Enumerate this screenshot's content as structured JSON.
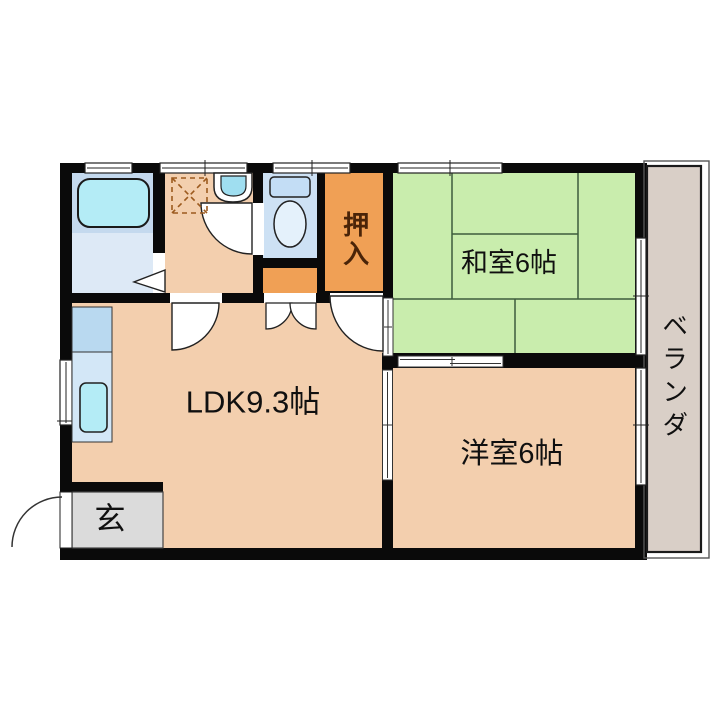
{
  "plan": {
    "type": "apartment-floor-plan",
    "rooms": {
      "washitsu": {
        "label": "和室6帖"
      },
      "oshiire": {
        "label": "押入"
      },
      "ldk": {
        "label": "LDK9.3帖"
      },
      "youshitsu": {
        "label": "洋室6帖"
      },
      "veranda": {
        "label": "ベランダ"
      },
      "genkan": {
        "label": "玄"
      }
    },
    "fixtures": [
      {
        "name": "bathtub-icon"
      },
      {
        "name": "washing-machine-space-icon"
      },
      {
        "name": "washbasin-icon"
      },
      {
        "name": "toilet-icon"
      },
      {
        "name": "kitchen-sink-icon"
      },
      {
        "name": "swing-door-icon"
      },
      {
        "name": "double-swing-door-icon"
      },
      {
        "name": "folding-door-icon"
      },
      {
        "name": "sliding-door-icon"
      },
      {
        "name": "window-icon"
      },
      {
        "name": "entrance-door-arc-icon"
      }
    ],
    "colors": {
      "wall": "#0a0a0a",
      "tatami_green": "#c9edad",
      "tatami_line": "#3d5c3d",
      "floor_tan": "#f3cfae",
      "closet_orange": "#f0a055",
      "bath_upper_blue": "#c4d9ee",
      "bath_lower_blue": "#dde9f6",
      "fixture_cyan": "#b4ecf6",
      "toilet_floor_blue": "#cde1f4",
      "toilet_fill_blue": "#c3ddf5",
      "counter_upper_blue": "#b9d9f0",
      "counter_lower_blue": "#d3e7f7",
      "basin_cyan": "#9fdef0",
      "genkan_gray": "#dbdbdb",
      "veranda_beige": "#d9cfc7"
    }
  }
}
